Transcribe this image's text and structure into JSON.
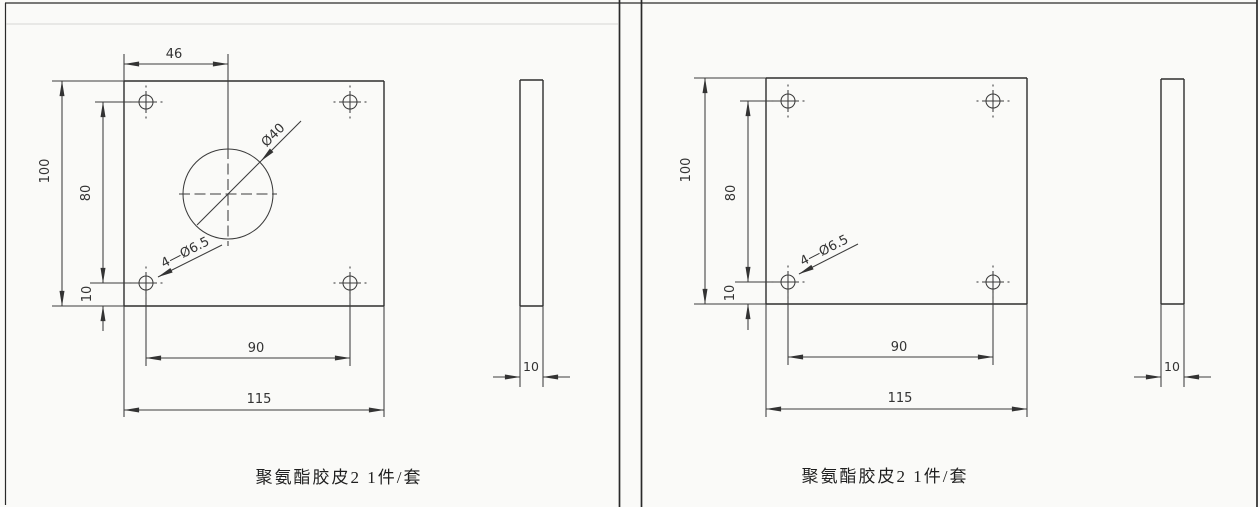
{
  "sheet": {
    "background": "#fafaf8",
    "ink": "#3c3c3c"
  },
  "panels": [
    {
      "caption": "聚氨酯胶皮2 1件/套",
      "front": {
        "hole_offset_top": "46",
        "height_overall": "100",
        "hole_span_vertical": "80",
        "hole_edge_offset": "10",
        "hole_span_horizontal": "90",
        "width_overall": "115",
        "center_hole": "Ø40",
        "corner_holes": "4—Ø6.5"
      },
      "side": {
        "thickness": "10"
      }
    },
    {
      "caption": "聚氨酯胶皮2 1件/套",
      "front": {
        "height_overall": "100",
        "hole_span_vertical": "80",
        "hole_edge_offset": "10",
        "hole_span_horizontal": "90",
        "width_overall": "115",
        "corner_holes": "4—Ø6.5"
      },
      "side": {
        "thickness": "10"
      }
    }
  ]
}
